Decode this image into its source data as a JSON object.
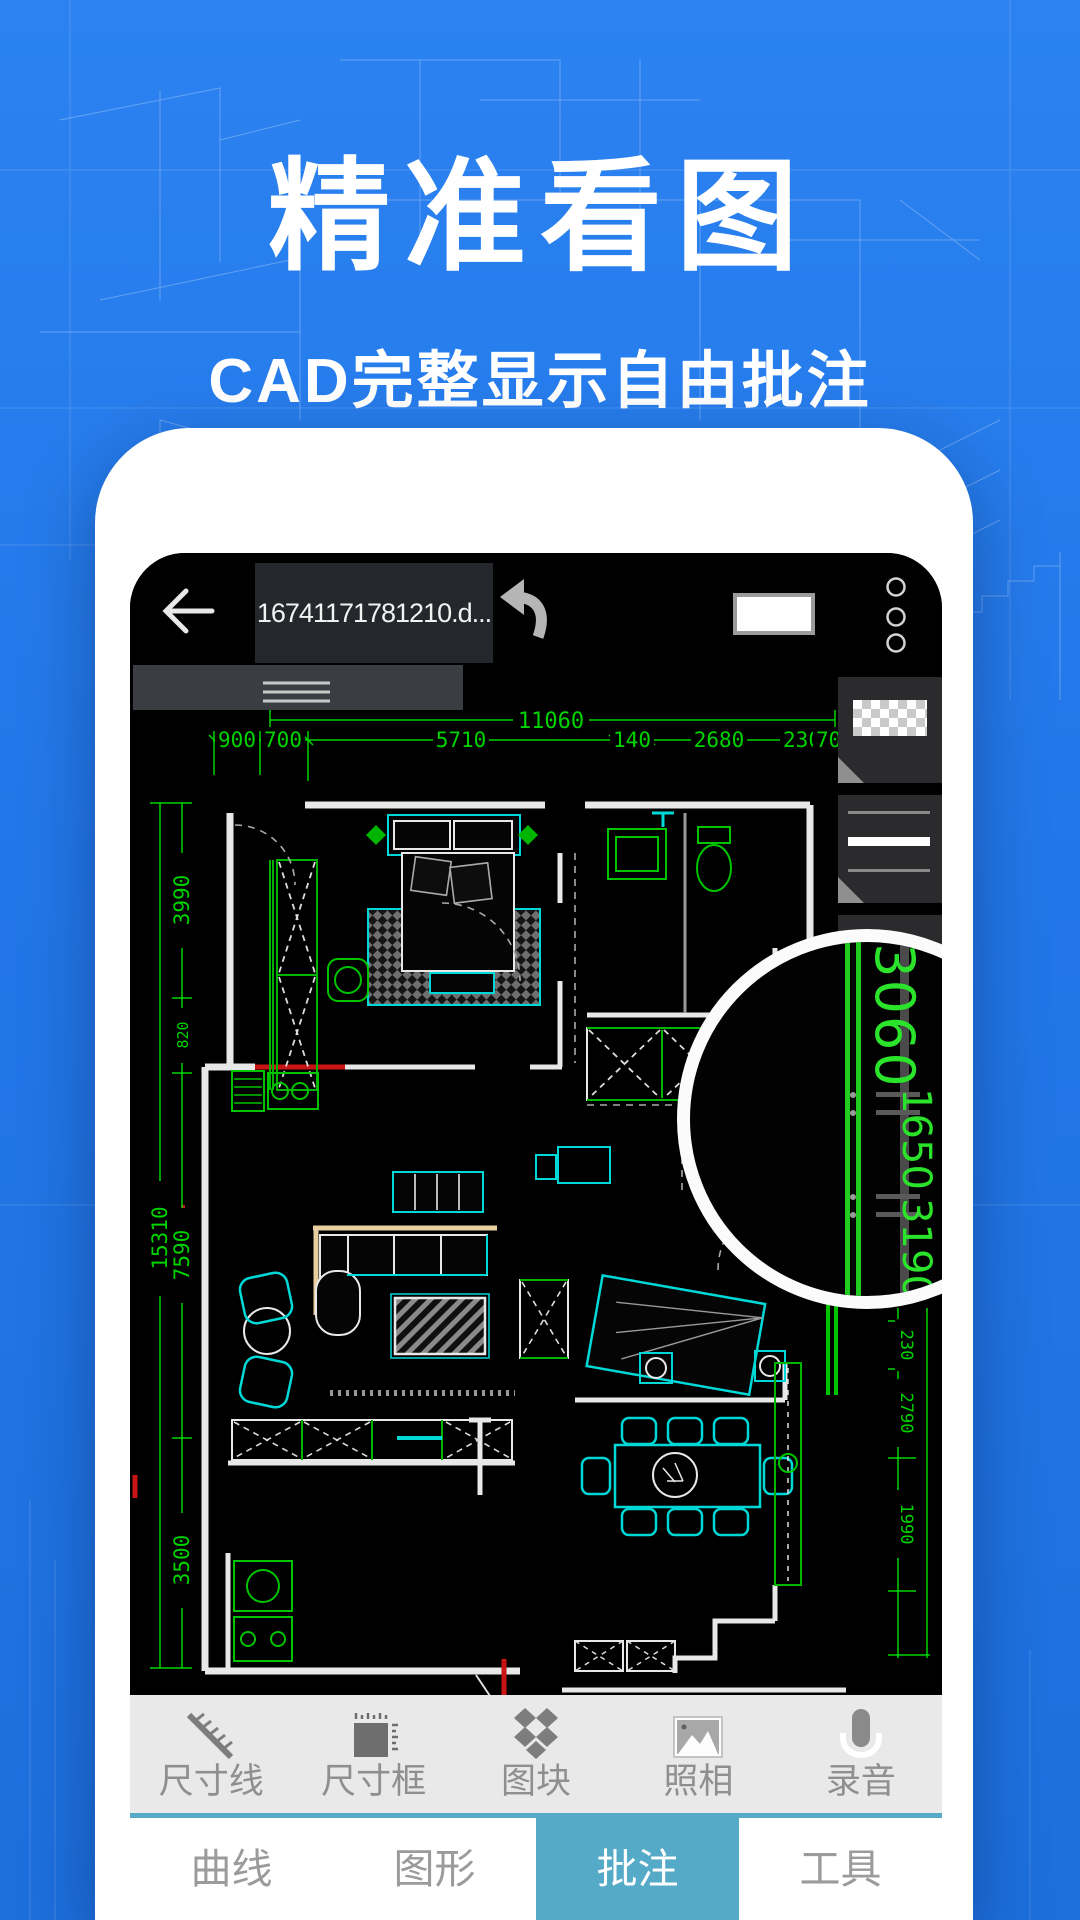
{
  "hero": {
    "title": "精准看图",
    "subtitle": "CAD完整显示自由批注"
  },
  "phone": {
    "topbar": {
      "filename": "16741171781210.d...",
      "back_icon": "back-arrow",
      "undo_icon": "undo-arrow",
      "menu_dots": 3
    },
    "cad": {
      "dims": {
        "top_total": "11060",
        "top_segments": [
          "900",
          "700",
          "5710",
          "140",
          "2680",
          "230",
          "700"
        ],
        "left_total": "15310",
        "left_segments": [
          "3990",
          "820",
          "7590",
          "3500"
        ],
        "right_segments": [
          "230",
          "2790",
          "1990"
        ]
      },
      "magnifier": {
        "values": [
          "3060",
          "1650",
          "3190"
        ]
      }
    },
    "side_panel": {
      "sections": [
        "transparent-color-swatch",
        "line-weight-selector",
        "collapsed-section"
      ]
    },
    "toolbar": {
      "items": [
        {
          "label": "尺寸线",
          "icon": "dimension-line-icon"
        },
        {
          "label": "尺寸框",
          "icon": "dimension-box-icon"
        },
        {
          "label": "图块",
          "icon": "block-icon"
        },
        {
          "label": "照相",
          "icon": "camera-icon"
        },
        {
          "label": "录音",
          "icon": "record-icon"
        }
      ]
    },
    "tabbar": {
      "tabs": [
        {
          "label": "曲线"
        },
        {
          "label": "图形"
        },
        {
          "label": "批注"
        },
        {
          "label": "工具"
        }
      ],
      "active": "批注"
    }
  },
  "colors": {
    "background": "#2277e8",
    "accent_teal": "#55aac8",
    "cad_green": "#00d400",
    "cad_cyan": "#00dcdc",
    "cad_red": "#c81414",
    "magnifier_green": "#2be32b"
  }
}
